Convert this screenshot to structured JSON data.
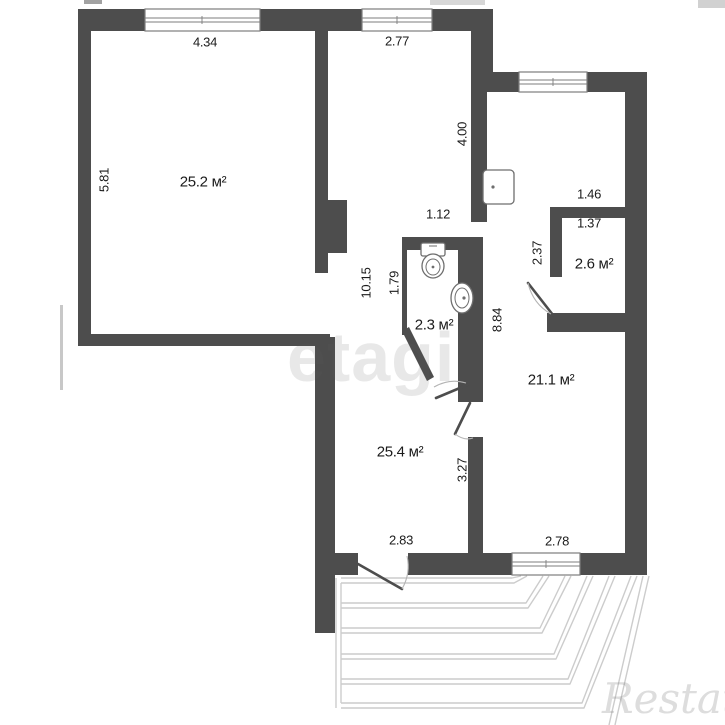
{
  "floorplan": {
    "background_color": "#ffffff",
    "wall_color": "#4d4d4d",
    "balcony_line_color": "#cccccc",
    "label_color": "#1b1b1b",
    "watermark_center": "etagi",
    "watermark_corner": "Restate",
    "rooms": [
      {
        "area_label": "25.2 м²"
      },
      {
        "area_label": "25.4 м²"
      },
      {
        "area_label": "21.1 м²"
      },
      {
        "area_label": "2.6 м²"
      },
      {
        "area_label": "2.3 м²"
      }
    ],
    "labels": [
      {
        "text": "4.34",
        "x": 205,
        "y": 42,
        "rot": 0,
        "kind": "dim"
      },
      {
        "text": "2.77",
        "x": 397,
        "y": 41,
        "rot": 0,
        "kind": "dim"
      },
      {
        "text": "5.81",
        "x": 104,
        "y": 180,
        "rot": -90,
        "kind": "dim"
      },
      {
        "text": "25.2 м²",
        "x": 203,
        "y": 182,
        "rot": 0,
        "kind": "area"
      },
      {
        "text": "4.00",
        "x": 462,
        "y": 134,
        "rot": -90,
        "kind": "dim"
      },
      {
        "text": "1.12",
        "x": 438,
        "y": 214,
        "rot": 0,
        "kind": "dim"
      },
      {
        "text": "1.46",
        "x": 589,
        "y": 194,
        "rot": 0,
        "kind": "dim"
      },
      {
        "text": "1.37",
        "x": 589,
        "y": 223,
        "rot": 0,
        "kind": "dim"
      },
      {
        "text": "2.37",
        "x": 537,
        "y": 253,
        "rot": -90,
        "kind": "dim"
      },
      {
        "text": "2.6 м²",
        "x": 594,
        "y": 264,
        "rot": 0,
        "kind": "area"
      },
      {
        "text": "10.15",
        "x": 366,
        "y": 283,
        "rot": -90,
        "kind": "dim"
      },
      {
        "text": "1.79",
        "x": 394,
        "y": 283,
        "rot": -90,
        "kind": "dim"
      },
      {
        "text": "2.3 м²",
        "x": 434,
        "y": 325,
        "rot": 0,
        "kind": "area"
      },
      {
        "text": "8.84",
        "x": 497,
        "y": 320,
        "rot": -90,
        "kind": "dim"
      },
      {
        "text": "21.1 м²",
        "x": 551,
        "y": 380,
        "rot": 0,
        "kind": "area"
      },
      {
        "text": "25.4 м²",
        "x": 400,
        "y": 452,
        "rot": 0,
        "kind": "area"
      },
      {
        "text": "3.27",
        "x": 462,
        "y": 470,
        "rot": -90,
        "kind": "dim"
      },
      {
        "text": "2.83",
        "x": 401,
        "y": 540,
        "rot": 0,
        "kind": "dim"
      },
      {
        "text": "2.78",
        "x": 557,
        "y": 541,
        "rot": 0,
        "kind": "dim"
      }
    ]
  }
}
